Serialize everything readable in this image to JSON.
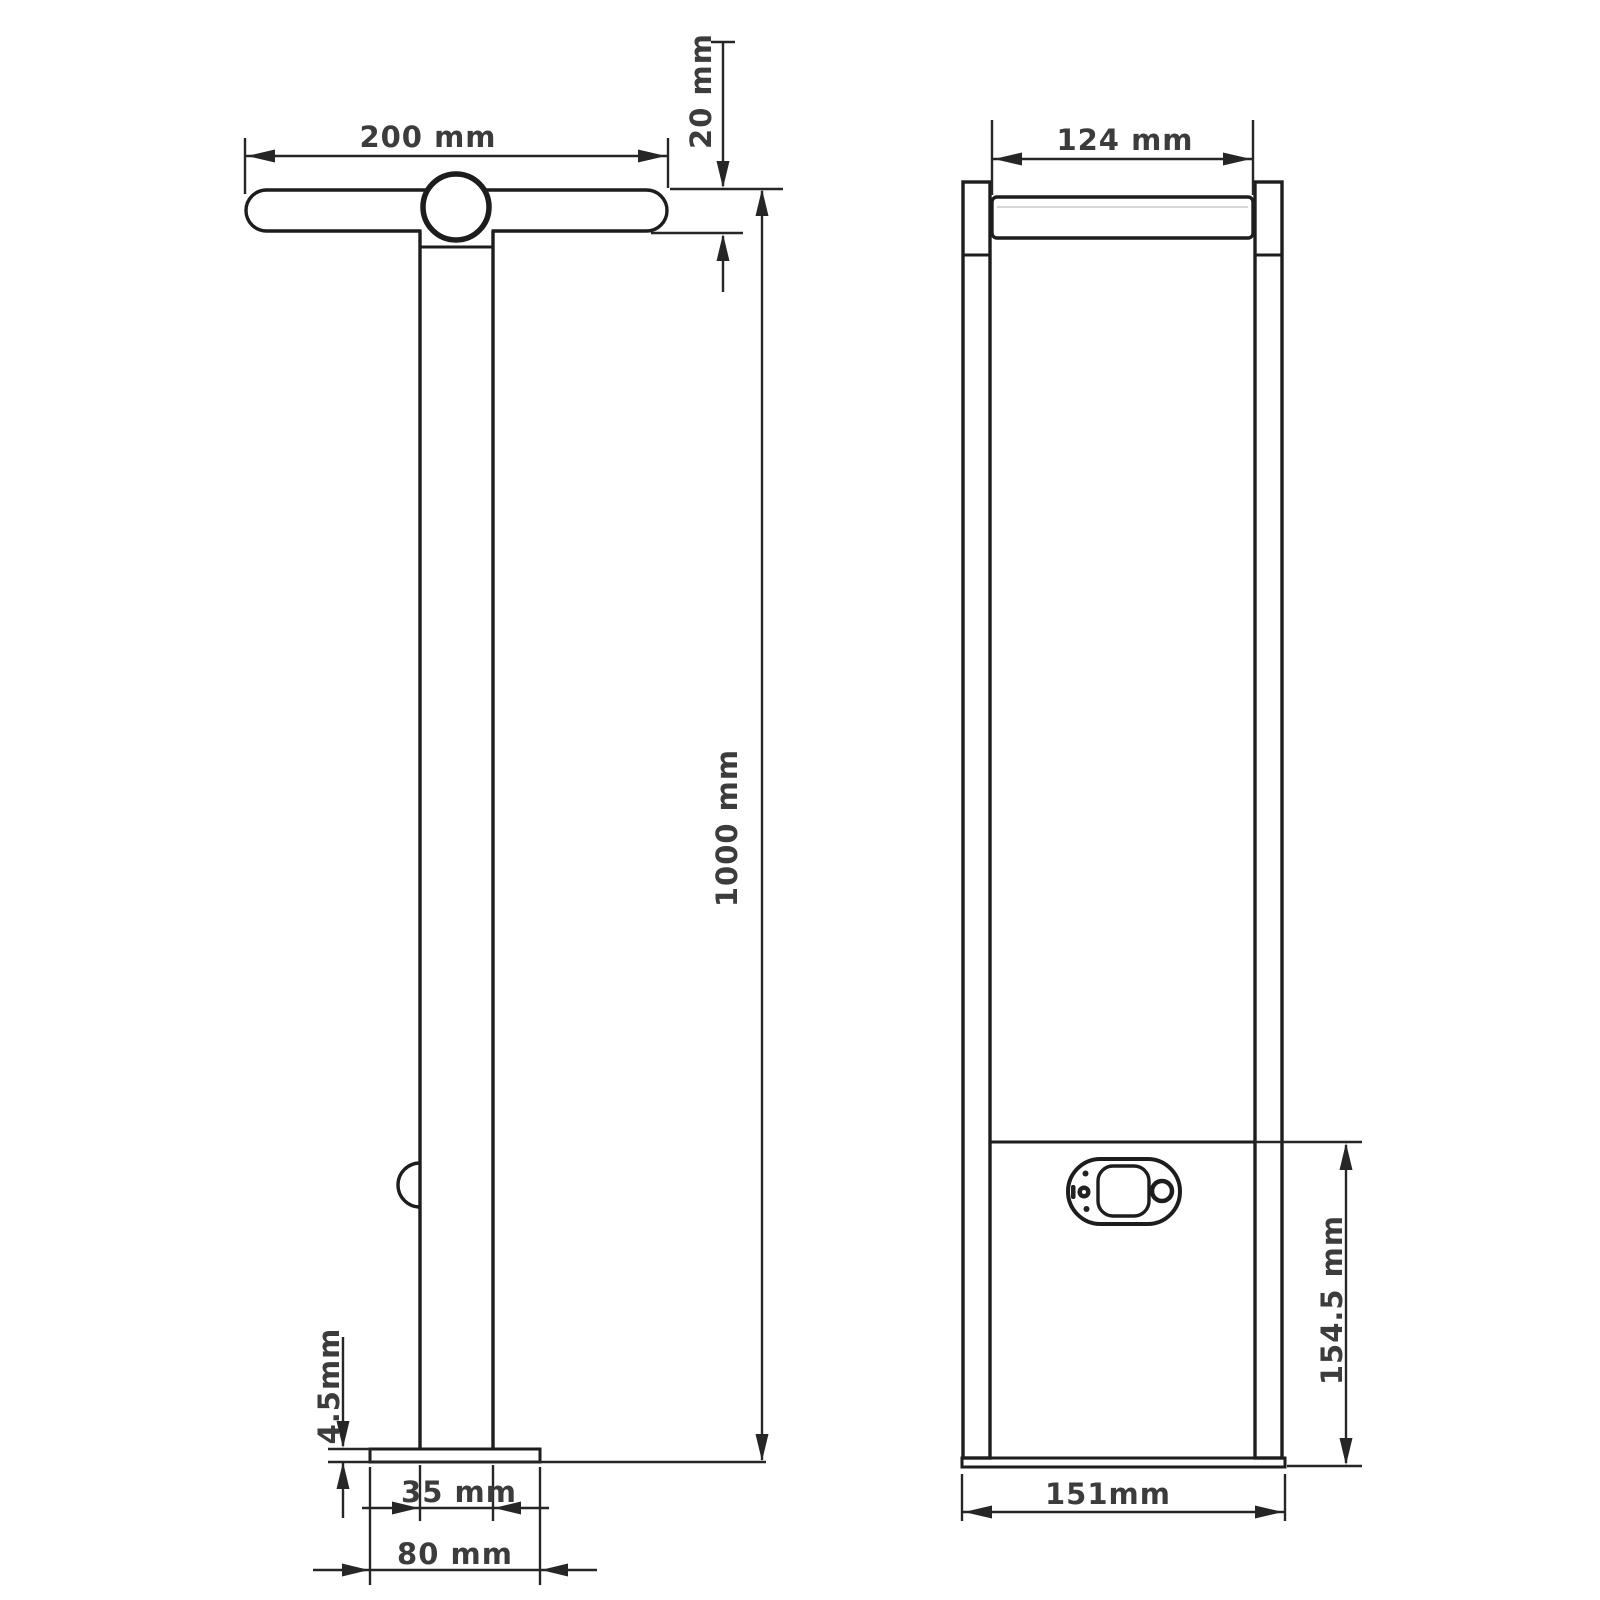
{
  "drawing": {
    "side_view": {
      "head_length": "200 mm",
      "head_thickness": "20 mm",
      "overall_height": "1000 mm",
      "base_plate_thickness": "4.5mm",
      "post_width": "35 mm",
      "base_plate_width": "80 mm"
    },
    "front_view": {
      "head_width": "124 mm",
      "lower_section_height": "154.5 mm",
      "overall_width": "151mm"
    }
  }
}
